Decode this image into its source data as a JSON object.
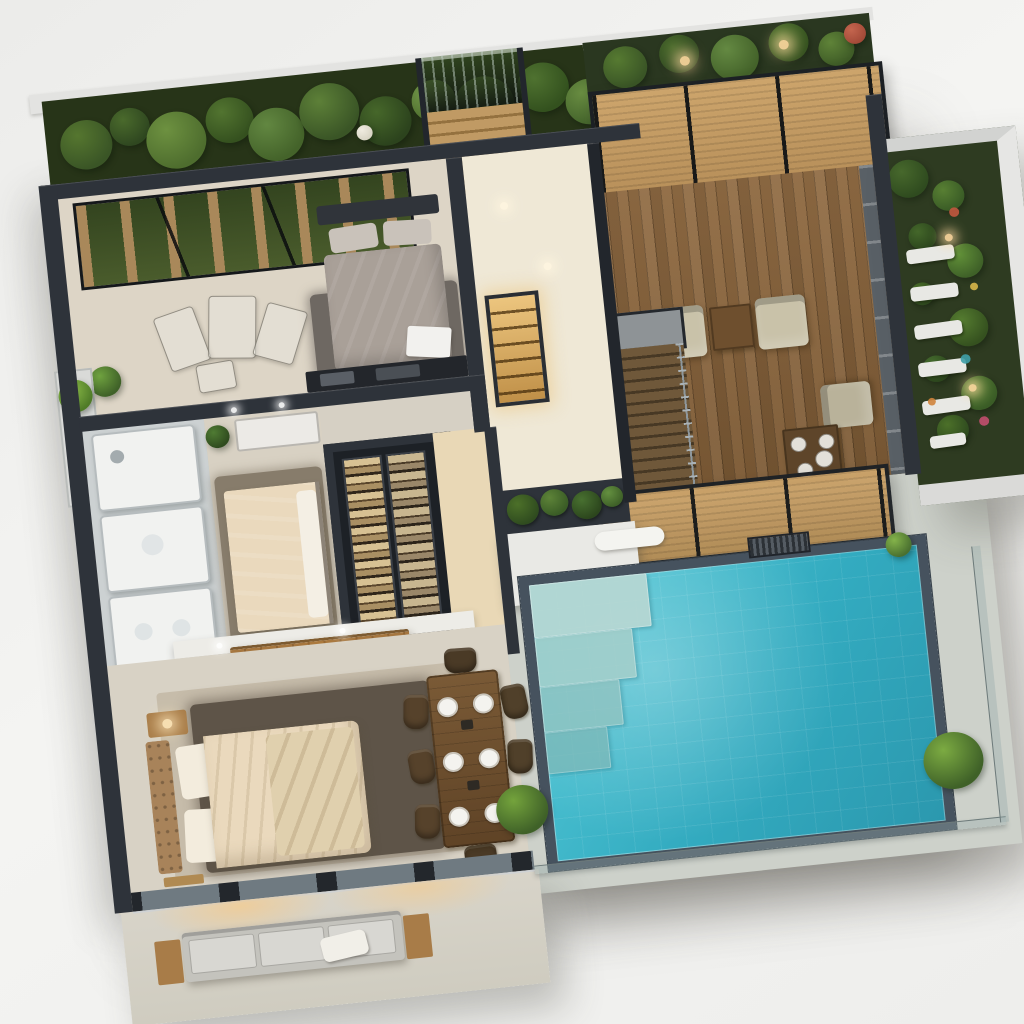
{
  "scene": {
    "kind": "3d-isometric-floorplan-render",
    "style": "modern-villa-with-pool"
  },
  "palette": {
    "wallDark": "#2e333a",
    "wallDarker": "#22262c",
    "parapet": "#e3e3e1",
    "floorGrey": "#d6d0c4",
    "hallFloor": "#efe8d6",
    "corridorFloor": "#e9d8b6",
    "bedroom2Floor": "#ddd5c6",
    "bedroom3Floor": "#d8d1c3",
    "deckA": "#916c44",
    "deckB": "#7c5a35",
    "pergola": "#c39a63",
    "canopy": "#c7a068",
    "rugGrey": "#6e6862",
    "rugBrown": "#5e5448",
    "carpet": "#c6bcaa",
    "bedGrey": "#a9a098",
    "bedCream": "#ead9bd",
    "headboard": "#a8835a",
    "sofaBase": "#c4c3bd",
    "cushion": "#d8d7d2",
    "woodAccent": "#a87c48",
    "water1": "#55cbd9",
    "water2": "#2b98ae",
    "poolBorder": "#46525e",
    "poolDeck": "#cdd1ca",
    "gardenGround": "#273418",
    "amber": "#d8b06a",
    "fire": "#f4a83c",
    "patio": "#d5d1c6",
    "bathFloor": "#ccd1d2",
    "closetInner": "#1d2126",
    "glass": "#6f7a81"
  },
  "garden": {
    "top_trees": [
      {
        "x": 40,
        "y": 50,
        "r": 26,
        "c": "#3a5526",
        "c2": "#55762f"
      },
      {
        "x": 85,
        "y": 36,
        "r": 20,
        "c": "#2f4720",
        "c2": "#4a6a2c"
      },
      {
        "x": 130,
        "y": 55,
        "r": 30,
        "c": "#4e6d2e",
        "c2": "#6d9140"
      },
      {
        "x": 185,
        "y": 40,
        "r": 24,
        "c": "#35511f",
        "c2": "#527430"
      },
      {
        "x": 230,
        "y": 60,
        "r": 28,
        "c": "#44632a",
        "c2": "#628741"
      },
      {
        "x": 285,
        "y": 42,
        "r": 30,
        "c": "#3a5526",
        "c2": "#5d8038"
      },
      {
        "x": 340,
        "y": 58,
        "r": 26,
        "c": "#2c431d",
        "c2": "#46672a"
      },
      {
        "x": 390,
        "y": 42,
        "r": 22,
        "c": "#4e6d2e",
        "c2": "#74994a"
      },
      {
        "x": 398,
        "y": 66,
        "r": 9,
        "c": "#8f3d2e",
        "c2": "#c05744"
      },
      {
        "x": 440,
        "y": 52,
        "r": 30,
        "c": "#3f5c27",
        "c2": "#5f8338"
      },
      {
        "x": 500,
        "y": 40,
        "r": 26,
        "c": "#33511e",
        "c2": "#4f7230"
      },
      {
        "x": 545,
        "y": 60,
        "r": 24,
        "c": "#45652c",
        "c2": "#688c41"
      },
      {
        "x": 575,
        "y": 36,
        "r": 18,
        "c": "#2f4720",
        "c2": "#497029"
      },
      {
        "x": 318,
        "y": 68,
        "r": 8,
        "c": "#d8d4c4",
        "c2": "#f0ece0"
      }
    ],
    "top_right_trees": [
      {
        "x": 40,
        "y": 30,
        "r": 22,
        "c": "#3a5526",
        "c2": "#567a31"
      },
      {
        "x": 95,
        "y": 22,
        "r": 20,
        "c": "#2f4720",
        "c2": "#4a6a2c"
      },
      {
        "x": 150,
        "y": 32,
        "r": 24,
        "c": "#44632a",
        "c2": "#648942"
      },
      {
        "x": 205,
        "y": 22,
        "r": 20,
        "c": "#35511f",
        "c2": "#527430"
      },
      {
        "x": 252,
        "y": 34,
        "r": 18,
        "c": "#3f5c27",
        "c2": "#5f8338"
      },
      {
        "x": 272,
        "y": 20,
        "r": 11,
        "c": "#a34a38",
        "c2": "#c4654e"
      }
    ],
    "planter_shrubs": [
      {
        "x": 24,
        "y": 22,
        "r": 16,
        "c": "#2f4b1f",
        "c2": "#4c7029"
      },
      {
        "x": 56,
        "y": 18,
        "r": 14,
        "c": "#3a5c26",
        "c2": "#5d8338"
      },
      {
        "x": 88,
        "y": 24,
        "r": 15,
        "c": "#2c461d",
        "c2": "#487030"
      },
      {
        "x": 114,
        "y": 18,
        "r": 11,
        "c": "#3f6128",
        "c2": "#649040"
      }
    ],
    "side_foliage": [
      {
        "x": 22,
        "y": 30,
        "r": 20,
        "c": "#2f4b1f",
        "c2": "#47682c"
      },
      {
        "x": 60,
        "y": 52,
        "r": 16,
        "c": "#3a5c26",
        "c2": "#587f33"
      },
      {
        "x": 30,
        "y": 92,
        "r": 14,
        "c": "#2c461d",
        "c2": "#44672a"
      },
      {
        "x": 70,
        "y": 122,
        "r": 18,
        "c": "#3f6128",
        "c2": "#619038"
      },
      {
        "x": 24,
        "y": 152,
        "r": 12,
        "c": "#2f4b1f",
        "c2": "#4c7029"
      },
      {
        "x": 66,
        "y": 192,
        "r": 20,
        "c": "#35511f",
        "c2": "#557c30"
      },
      {
        "x": 30,
        "y": 232,
        "r": 14,
        "c": "#2c461d",
        "c2": "#487030"
      },
      {
        "x": 70,
        "y": 262,
        "r": 18,
        "c": "#3a5c26",
        "c2": "#5d8338"
      },
      {
        "x": 40,
        "y": 298,
        "r": 16,
        "c": "#2f4b1f",
        "c2": "#4c7029"
      }
    ],
    "side_flowers": [
      {
        "x": 64,
        "y": 70,
        "r": 5,
        "c": "#c2583f"
      },
      {
        "x": 76,
        "y": 150,
        "r": 4,
        "c": "#d8b84a"
      },
      {
        "x": 60,
        "y": 225,
        "r": 5,
        "c": "#3fa0a8"
      },
      {
        "x": 72,
        "y": 292,
        "r": 5,
        "c": "#c24f6e"
      },
      {
        "x": 22,
        "y": 266,
        "r": 4,
        "c": "#d0843c"
      }
    ],
    "side_stones": [
      {
        "x": 12,
        "y": 104,
        "w": 48,
        "h": 15,
        "rot": -2
      },
      {
        "x": 12,
        "y": 144,
        "w": 48,
        "h": 15,
        "rot": -1
      },
      {
        "x": 12,
        "y": 184,
        "w": 48,
        "h": 15,
        "rot": -2
      },
      {
        "x": 12,
        "y": 224,
        "w": 48,
        "h": 15,
        "rot": -1
      },
      {
        "x": 12,
        "y": 264,
        "w": 48,
        "h": 15,
        "rot": -2
      },
      {
        "x": 16,
        "y": 302,
        "w": 36,
        "h": 13,
        "rot": -2
      }
    ]
  },
  "pool": {
    "steps": [
      {
        "x": 0,
        "y": 0,
        "w": 118,
        "h": 56,
        "c": "#b9d8d3",
        "o": 0.9
      },
      {
        "x": 0,
        "y": 56,
        "w": 98,
        "h": 52,
        "c": "#a6cfca",
        "o": 0.85
      },
      {
        "x": 0,
        "y": 108,
        "w": 80,
        "h": 48,
        "c": "#92c4c1",
        "o": 0.8
      },
      {
        "x": 0,
        "y": 156,
        "w": 63,
        "h": 44,
        "c": "#7fb9b8",
        "o": 0.75
      }
    ]
  },
  "deck": {
    "armchairs": [
      {
        "x": 46,
        "y": 128,
        "w": 50,
        "h": 54,
        "rot": 0,
        "c": "#c9c2a9"
      },
      {
        "x": 148,
        "y": 128,
        "w": 50,
        "h": 54,
        "rot": 0,
        "c": "#c9c2a9"
      },
      {
        "x": 206,
        "y": 224,
        "w": 46,
        "h": 50,
        "rot": -90,
        "c": "#b9b29a"
      }
    ],
    "tables": [
      {
        "x": 102,
        "y": 132,
        "w": 42,
        "h": 46,
        "c": "#6e4f2e"
      },
      {
        "x": 162,
        "y": 268,
        "w": 56,
        "h": 58,
        "c": "#5e452a"
      }
    ],
    "tabletop_items": [
      {
        "x": 176,
        "y": 284,
        "r": 7,
        "c": "#f2f1ed"
      },
      {
        "x": 204,
        "y": 284,
        "r": 7,
        "c": "#f2f1ed"
      },
      {
        "x": 180,
        "y": 312,
        "r": 7,
        "c": "#f2f1ed"
      },
      {
        "x": 200,
        "y": 302,
        "r": 8,
        "c": "#d8c04a"
      }
    ]
  },
  "dining": {
    "plates": [
      {
        "x": 34,
        "y": 40,
        "w": 17,
        "h": 17
      },
      {
        "x": 34,
        "y": 98,
        "w": 17,
        "h": 17
      },
      {
        "x": 34,
        "y": 156,
        "w": 17,
        "h": 17
      },
      {
        "x": 70,
        "y": 40,
        "w": 17,
        "h": 17
      },
      {
        "x": 70,
        "y": 98,
        "w": 17,
        "h": 17
      },
      {
        "x": 70,
        "y": 156,
        "w": 17,
        "h": 17
      }
    ],
    "centerpieces": [
      {
        "x": 56,
        "y": 66,
        "w": 12,
        "h": 10,
        "c": "#2e2a24"
      },
      {
        "x": 56,
        "y": 130,
        "w": 12,
        "h": 10,
        "c": "#2e2a24"
      }
    ],
    "chairs": [
      {
        "x": 0,
        "y": 34,
        "w": 25,
        "h": 36,
        "rot": 6,
        "c": "#56422b"
      },
      {
        "x": 0,
        "y": 92,
        "w": 25,
        "h": 36,
        "rot": -4,
        "c": "#56422b"
      },
      {
        "x": 0,
        "y": 150,
        "w": 25,
        "h": 36,
        "rot": 5,
        "c": "#56422b"
      },
      {
        "x": 99,
        "y": 34,
        "w": 25,
        "h": 36,
        "rot": -6,
        "c": "#50402a"
      },
      {
        "x": 99,
        "y": 92,
        "w": 25,
        "h": 36,
        "rot": 4,
        "c": "#50402a"
      },
      {
        "x": 99,
        "y": 150,
        "w": 25,
        "h": 36,
        "rot": -5,
        "c": "#50402a"
      },
      {
        "x": 46,
        "y": -10,
        "w": 32,
        "h": 26,
        "rot": 2,
        "c": "#4a3a26"
      },
      {
        "x": 46,
        "y": 198,
        "w": 32,
        "h": 26,
        "rot": -2,
        "c": "#4a3a26"
      }
    ]
  },
  "bedroom2": {
    "ghost_furniture": [
      {
        "x": 88,
        "y": 130,
        "w": 40,
        "h": 58,
        "rot": -14
      },
      {
        "x": 136,
        "y": 120,
        "w": 46,
        "h": 64,
        "rot": 6
      },
      {
        "x": 186,
        "y": 136,
        "w": 40,
        "h": 56,
        "rot": 22
      },
      {
        "x": 120,
        "y": 188,
        "w": 36,
        "h": 28,
        "rot": -4
      }
    ]
  },
  "bath": {
    "fixtures": [
      {
        "x": 8,
        "y": 6,
        "w": 100,
        "h": 78
      },
      {
        "x": 8,
        "y": 92,
        "w": 100,
        "h": 78
      },
      {
        "x": 8,
        "y": 178,
        "w": 100,
        "h": 88
      }
    ],
    "details": [
      {
        "x": 32,
        "y": 32,
        "r": 7,
        "c": "#9aa3a6"
      },
      {
        "x": 58,
        "y": 128,
        "r": 11,
        "c": "#dfe3e4"
      },
      {
        "x": 40,
        "y": 218,
        "r": 9,
        "c": "#dde2e3"
      },
      {
        "x": 78,
        "y": 218,
        "r": 9,
        "c": "#dde2e3"
      }
    ]
  },
  "lights": [
    {
      "x": 505,
      "y": 168,
      "r": 4,
      "c": "#fff6e0"
    },
    {
      "x": 542,
      "y": 236,
      "r": 4,
      "c": "#fff6e0"
    },
    {
      "x": 215,
      "y": 352,
      "r": 3,
      "c": "#ffffff"
    },
    {
      "x": 263,
      "y": 352,
      "r": 3,
      "c": "#ffffff"
    },
    {
      "x": 176,
      "y": 597,
      "r": 3,
      "c": "#ffffff"
    },
    {
      "x": 300,
      "y": 595,
      "r": 3,
      "c": "#ffffff"
    },
    {
      "x": 700,
      "y": 36,
      "r": 5,
      "c": "#ffd9a0"
    },
    {
      "x": 800,
      "y": 30,
      "r": 5,
      "c": "#ffd9a0"
    },
    {
      "x": 944,
      "y": 250,
      "r": 4,
      "c": "#ffd9a0"
    },
    {
      "x": 952,
      "y": 410,
      "r": 4,
      "c": "#ffd9a0"
    }
  ]
}
